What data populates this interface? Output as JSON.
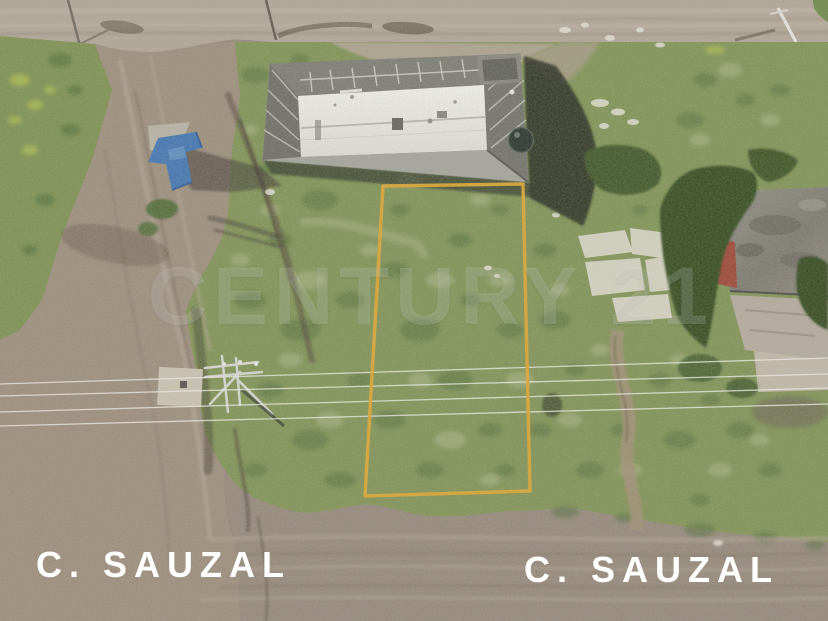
{
  "scene": {
    "description": "Aerial drone photo of a vacant grassy land lot outlined with a yellow boundary, flanked by dirt roads, a warehouse building with white roof and water tank, power lines, a blue roadside structure and a neighboring building with red roof remnants"
  },
  "watermark": {
    "text": "CENTURY 21"
  },
  "street_labels": [
    {
      "text": "C. SAUZAL"
    },
    {
      "text": "C. SAUZAL"
    }
  ],
  "colors": {
    "boundary_yellow": "#dca42e",
    "grass_green": "#7f9254",
    "dark_vegetation": "#33491f",
    "dirt_road_top": "#b1a697",
    "dirt_road_left": "#9b8d7b",
    "dirt_road_bottom": "#94887a",
    "building_roof_white": "#eeeeea",
    "building_wall_gray": "#8f9089",
    "building_shadow": "#20251c",
    "water_tank_dark": "#27302b",
    "blue_structure": "#3f74b2",
    "red_roof": "#9c4434",
    "concrete_slab": "#dcd9cb",
    "label_white": "#ffffff"
  }
}
